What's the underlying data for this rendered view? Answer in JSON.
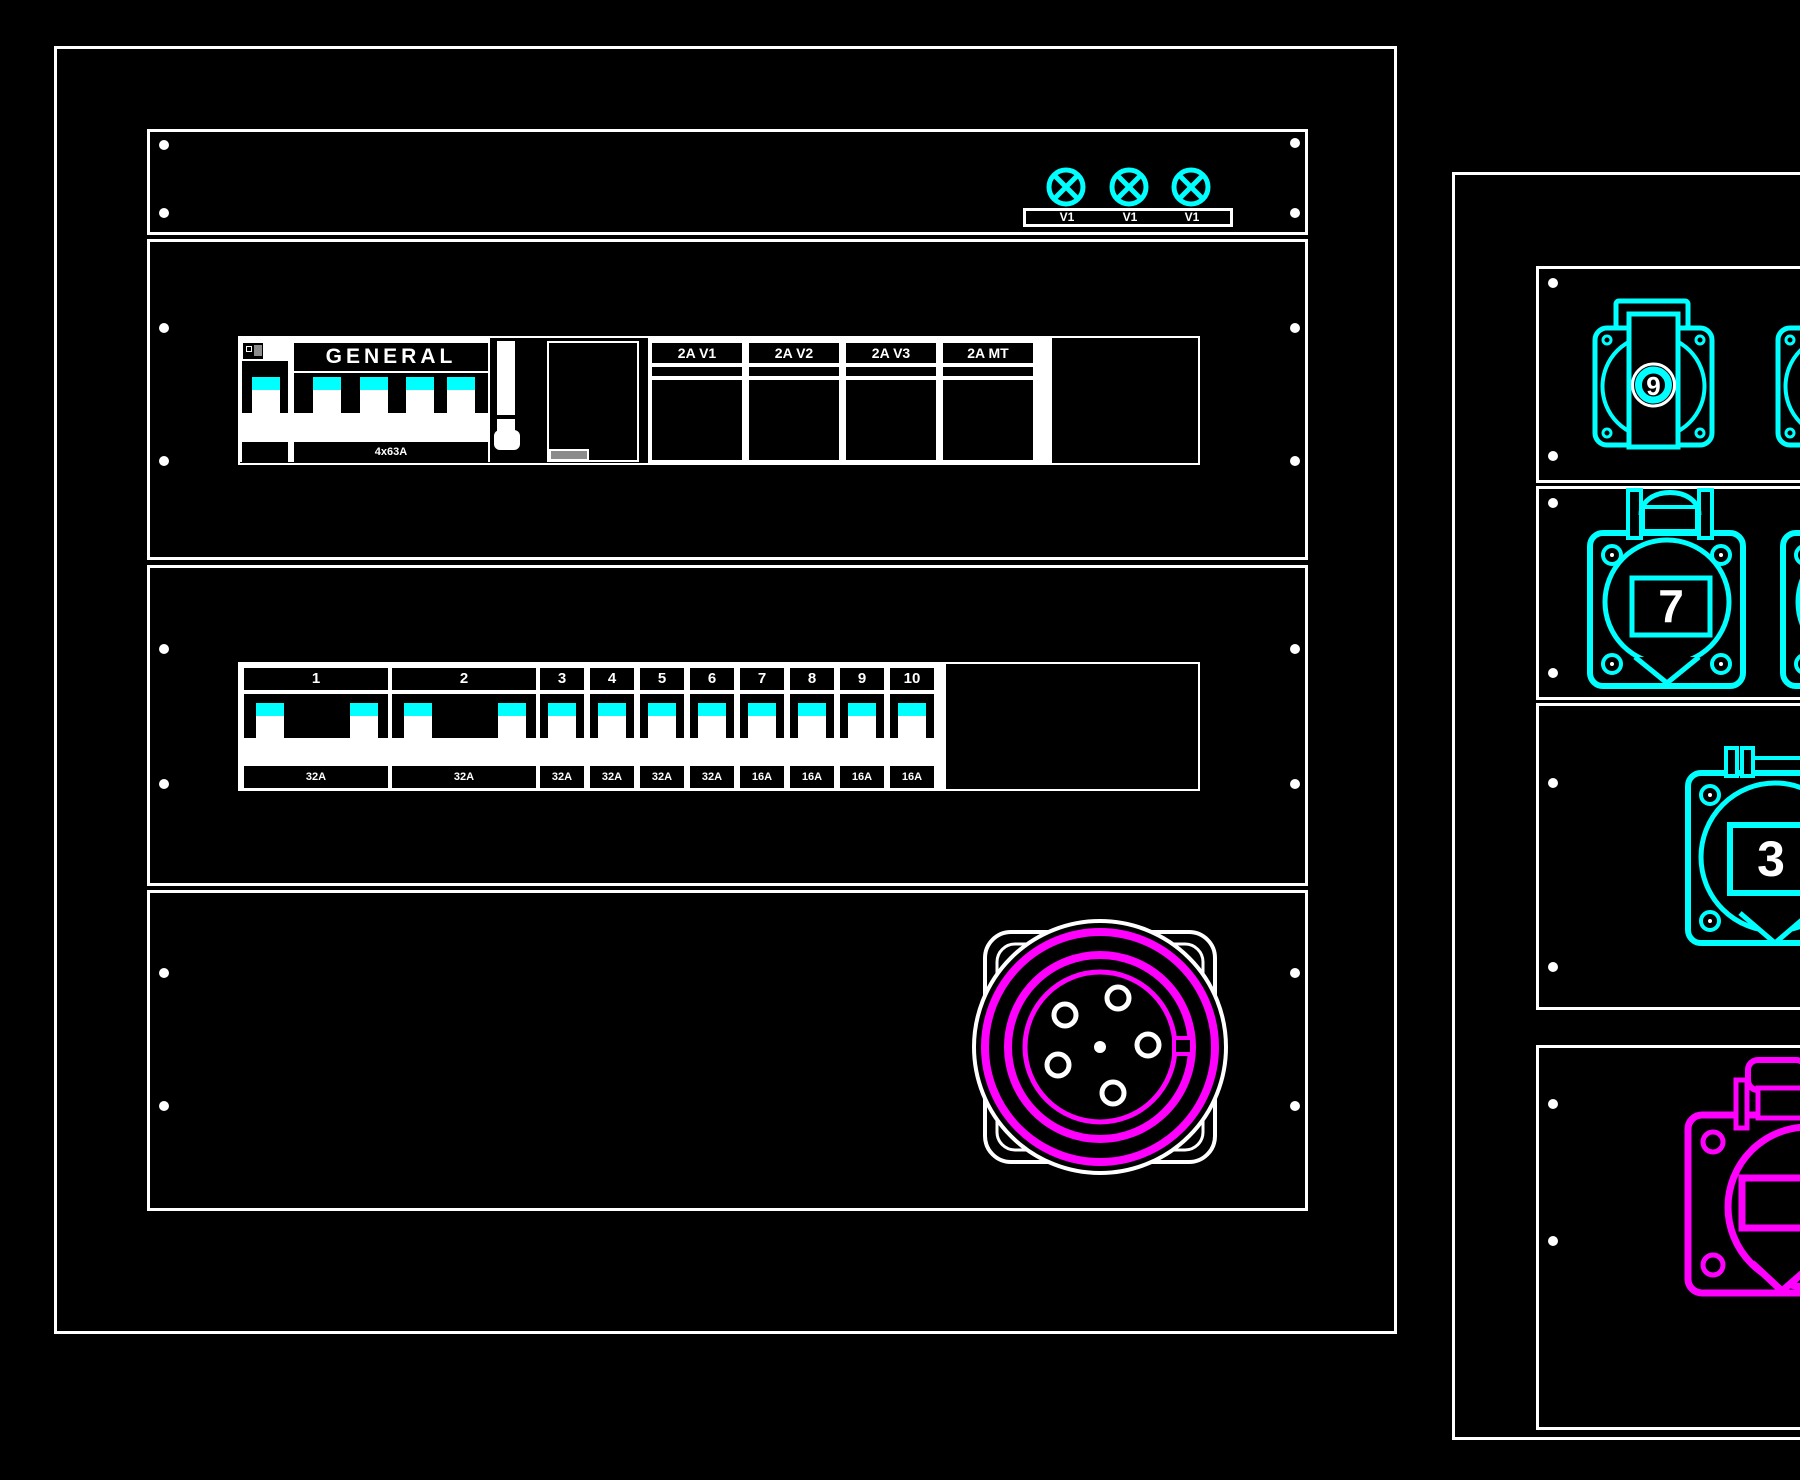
{
  "colors": {
    "background": "#000000",
    "line_white": "#ffffff",
    "device_cyan": "#00ffff",
    "device_magenta": "#ff00ff",
    "grey_accent": "#8c8c8c"
  },
  "left_panel": {
    "lamp_labels": [
      "V1",
      "V1",
      "V1"
    ],
    "main_breaker": {
      "label": "GENERAL",
      "rating": "4x63A"
    },
    "aux_breakers": [
      "2A V1",
      "2A V2",
      "2A V3",
      "2A MT"
    ],
    "circuit_breakers": [
      {
        "num": "1",
        "amp": "32A"
      },
      {
        "num": "2",
        "amp": "32A"
      },
      {
        "num": "3",
        "amp": "32A"
      },
      {
        "num": "4",
        "amp": "32A"
      },
      {
        "num": "5",
        "amp": "32A"
      },
      {
        "num": "6",
        "amp": "32A"
      },
      {
        "num": "7",
        "amp": "16A"
      },
      {
        "num": "8",
        "amp": "16A"
      },
      {
        "num": "9",
        "amp": "16A"
      },
      {
        "num": "10",
        "amp": "16A"
      }
    ]
  },
  "right_panel": {
    "socket_labels": {
      "row1": "9",
      "row2": "7",
      "row3": "3",
      "row4": ""
    }
  }
}
